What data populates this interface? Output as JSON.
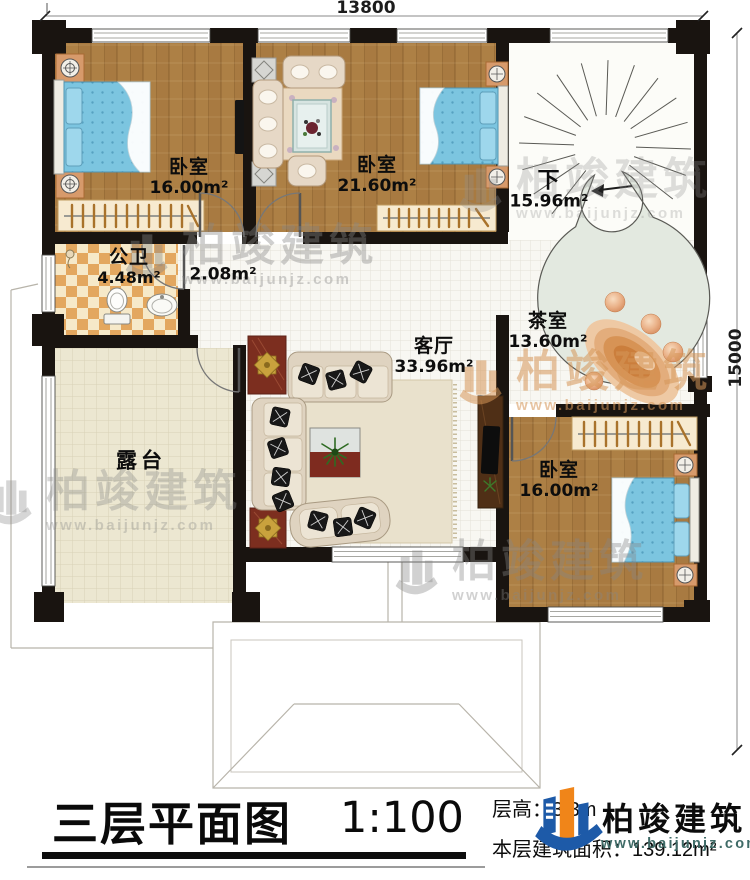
{
  "dimensions": {
    "top": "13800",
    "right": "15000"
  },
  "rooms": {
    "bedroom_tl": {
      "name": "卧室",
      "area": "16.00m²"
    },
    "bedroom_top": {
      "name": "卧室",
      "area": "21.60m²"
    },
    "stair": {
      "name": "下",
      "area": "15.96m²"
    },
    "bathroom": {
      "name": "公卫",
      "area": "4.48m²"
    },
    "hallway": {
      "area": "2.08m²"
    },
    "living": {
      "name": "客厅",
      "area": "33.96m²"
    },
    "tearoom": {
      "name": "茶室",
      "area": "13.60m²"
    },
    "bedroom_br": {
      "name": "卧室",
      "area": "16.00m²"
    },
    "terrace": {
      "name": "露台"
    }
  },
  "titleblock": {
    "title": "三层平面图",
    "scale": "1:100",
    "floor_height": "层高：3.3m",
    "floor_area": "本层建筑面积：139.12m²"
  },
  "brand": {
    "name": "柏竣建筑",
    "site": "www.baijunjz.com"
  },
  "watermark": {
    "name": "柏竣建筑",
    "site": "www.baijunjz.com"
  },
  "colors": {
    "wall": "#191410",
    "wood": "#a87a41",
    "accent_blue": "#1d5aa8",
    "accent_orange": "#f08519"
  }
}
